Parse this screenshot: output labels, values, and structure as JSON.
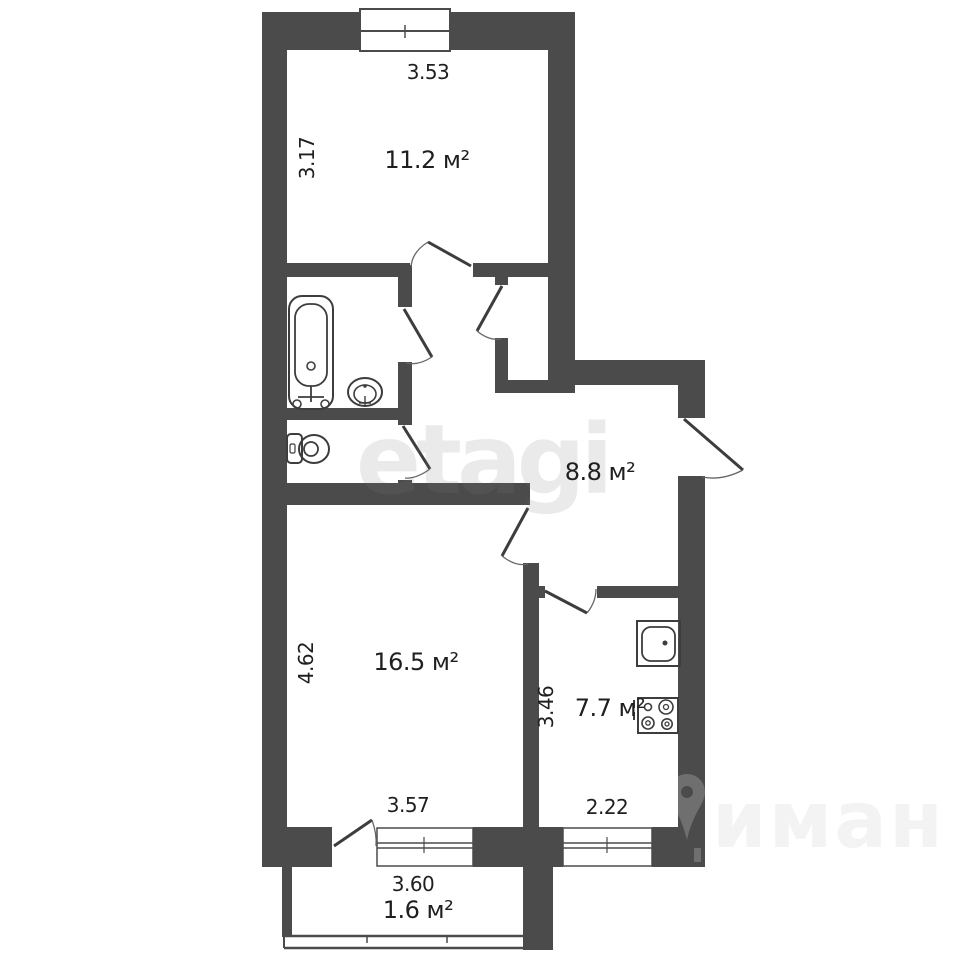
{
  "plan": {
    "type": "apartment-floor-plan",
    "units": "м",
    "rooms": {
      "top_room": {
        "area": "11.2 м²",
        "width_m": "3.53",
        "height_m": "3.17"
      },
      "hallway": {
        "area": "8.8 м²"
      },
      "living_room": {
        "area": "16.5 м²",
        "height_m": "4.62",
        "width_m": "3.57"
      },
      "kitchen": {
        "area": "7.7 м²",
        "height_m": "3.46",
        "width_m": "2.22"
      },
      "balcony": {
        "area": "1.6 м²",
        "width_m": "3.60"
      }
    },
    "fixtures": [
      "bathtub",
      "bath-sink",
      "toilet",
      "kitchen-sink",
      "stove"
    ],
    "watermark": {
      "primary": "etagi",
      "secondary": "иман"
    },
    "colors": {
      "wall": "#4b4b4b",
      "line": "#3d3d3d",
      "background": "#ffffff",
      "text": "#1f1f1f"
    }
  }
}
